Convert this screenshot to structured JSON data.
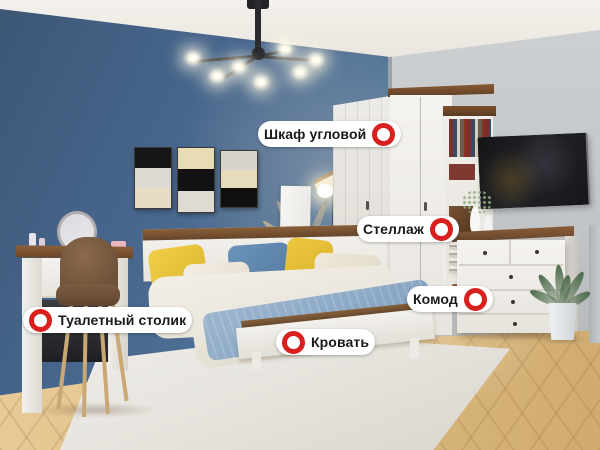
{
  "page": {
    "type": "interactive-room-photo",
    "room": "bedroom-furniture-set"
  },
  "hotspots": [
    {
      "id": "corner-wardrobe",
      "label": "Шкаф угловой",
      "marker_icon": "red-ring-hotspot",
      "marker_side": "right"
    },
    {
      "id": "shelving",
      "label": "Стеллаж",
      "marker_icon": "red-ring-hotspot",
      "marker_side": "right"
    },
    {
      "id": "dresser",
      "label": "Комод",
      "marker_icon": "red-ring-hotspot",
      "marker_side": "right"
    },
    {
      "id": "bed",
      "label": "Кровать",
      "marker_icon": "red-ring-hotspot",
      "marker_side": "left"
    },
    {
      "id": "dressing-table",
      "label": "Туалетный столик",
      "marker_icon": "red-ring-hotspot",
      "marker_side": "left"
    }
  ],
  "colors": {
    "accent_red": "#d8201e",
    "wall_blue": "#4a6a8c",
    "wall_gray": "#c6c9cb",
    "ceiling": "#efece7",
    "floor_wood": "#ddbe86",
    "rug": "#e9e6e1",
    "wood_accent": "#6f4930",
    "label_bg": "#ffffff",
    "label_text": "#1a1a1a"
  }
}
